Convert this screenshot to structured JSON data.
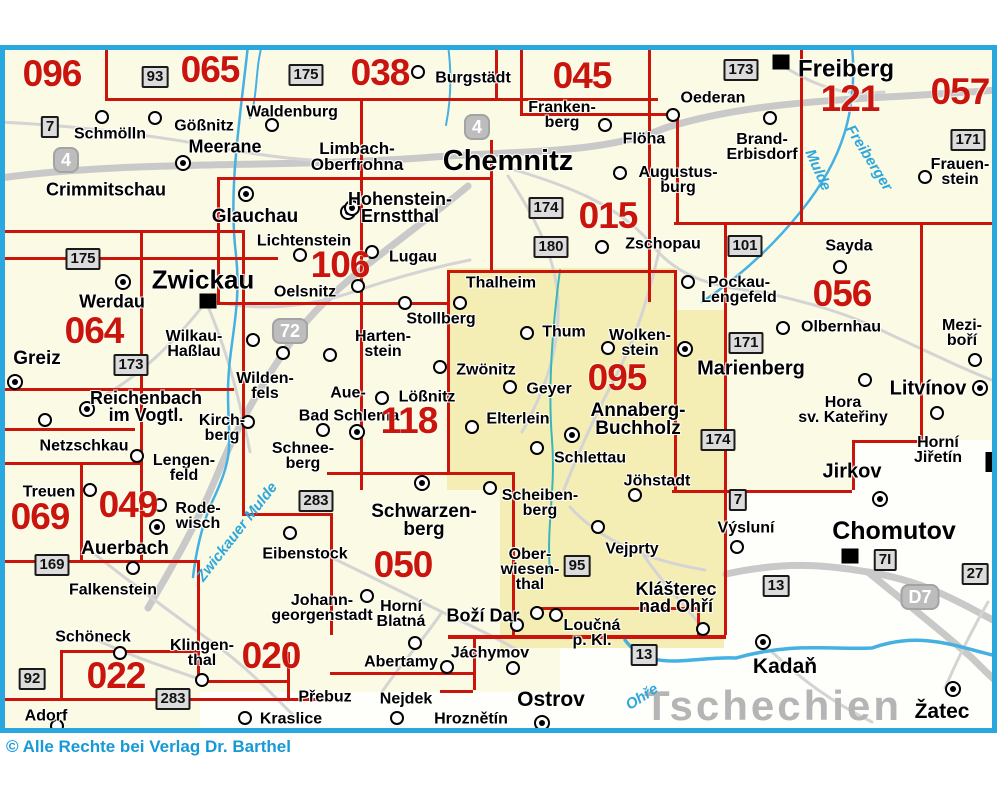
{
  "map": {
    "country_label": "Tschechien",
    "copyright": "© Alle Rechte bei Verlag Dr. Barthel",
    "colors": {
      "sheet_red": "#c9150c",
      "frame_blue": "#29a8e0",
      "river_blue": "#45b0e2",
      "base_cream": "#fbfae4",
      "highlight_yellow": "#f4eeb4",
      "road_gray": "#c9c9c9",
      "copyright_blue": "#1699d6",
      "country_gray": "#b5b5b5"
    },
    "sheet_numbers": [
      {
        "n": "096",
        "x": 52,
        "y": 74
      },
      {
        "n": "065",
        "x": 210,
        "y": 70
      },
      {
        "n": "038",
        "x": 380,
        "y": 73
      },
      {
        "n": "045",
        "x": 582,
        "y": 76
      },
      {
        "n": "121",
        "x": 850,
        "y": 99
      },
      {
        "n": "057",
        "x": 960,
        "y": 92
      },
      {
        "n": "015",
        "x": 608,
        "y": 216
      },
      {
        "n": "106",
        "x": 340,
        "y": 265
      },
      {
        "n": "056",
        "x": 842,
        "y": 294
      },
      {
        "n": "064",
        "x": 94,
        "y": 331
      },
      {
        "n": "095",
        "x": 617,
        "y": 378
      },
      {
        "n": "118",
        "x": 409,
        "y": 421
      },
      {
        "n": "069",
        "x": 40,
        "y": 517
      },
      {
        "n": "049",
        "x": 128,
        "y": 505
      },
      {
        "n": "050",
        "x": 403,
        "y": 565
      },
      {
        "n": "022",
        "x": 116,
        "y": 676
      },
      {
        "n": "020",
        "x": 271,
        "y": 656
      }
    ],
    "towns": [
      {
        "t": [
          "Schmölln"
        ],
        "x": 110,
        "y": 134
      },
      {
        "t": [
          "Gößnitz"
        ],
        "x": 204,
        "y": 126
      },
      {
        "t": [
          "Meerane"
        ],
        "x": 225,
        "y": 147,
        "s": 18
      },
      {
        "t": [
          "Waldenburg"
        ],
        "x": 292,
        "y": 112
      },
      {
        "t": [
          "Limbach-",
          "Oberfrohna"
        ],
        "x": 357,
        "y": 157,
        "s": 17
      },
      {
        "t": [
          "Burgstädt"
        ],
        "x": 473,
        "y": 78
      },
      {
        "t": [
          "Chemnitz"
        ],
        "x": 508,
        "y": 162,
        "s": 29
      },
      {
        "t": [
          "Franken-",
          "berg"
        ],
        "x": 562,
        "y": 115
      },
      {
        "t": [
          "Flöha"
        ],
        "x": 644,
        "y": 139
      },
      {
        "t": [
          "Oederan"
        ],
        "x": 713,
        "y": 98
      },
      {
        "t": [
          "Freiberg"
        ],
        "x": 846,
        "y": 70,
        "s": 24
      },
      {
        "t": [
          "Brand-",
          "Erbisdorf"
        ],
        "x": 762,
        "y": 147
      },
      {
        "t": [
          "Frauen-",
          "stein"
        ],
        "x": 960,
        "y": 172
      },
      {
        "t": [
          "Augustus-",
          "burg"
        ],
        "x": 678,
        "y": 180
      },
      {
        "t": [
          "Crimmitschau"
        ],
        "x": 106,
        "y": 190,
        "s": 18
      },
      {
        "t": [
          "Glauchau"
        ],
        "x": 255,
        "y": 217,
        "s": 19
      },
      {
        "t": [
          "Hohenstein-",
          "Ernstthal"
        ],
        "x": 400,
        "y": 208,
        "s": 18
      },
      {
        "t": [
          "Lichtenstein"
        ],
        "x": 304,
        "y": 241
      },
      {
        "t": [
          "Zschopau"
        ],
        "x": 663,
        "y": 244
      },
      {
        "t": [
          "Lugau"
        ],
        "x": 413,
        "y": 257
      },
      {
        "t": [
          "Oelsnitz"
        ],
        "x": 305,
        "y": 292
      },
      {
        "t": [
          "Sayda"
        ],
        "x": 849,
        "y": 246
      },
      {
        "t": [
          "Pockau-",
          "Lengefeld"
        ],
        "x": 739,
        "y": 290
      },
      {
        "t": [
          "Olbernhau"
        ],
        "x": 841,
        "y": 327
      },
      {
        "t": [
          "Zwickau"
        ],
        "x": 203,
        "y": 280,
        "s": 26
      },
      {
        "t": [
          "Werdau"
        ],
        "x": 112,
        "y": 302,
        "s": 18
      },
      {
        "t": [
          "Thalheim"
        ],
        "x": 501,
        "y": 283
      },
      {
        "t": [
          "Thum"
        ],
        "x": 564,
        "y": 332
      },
      {
        "t": [
          "Wolken-",
          "stein"
        ],
        "x": 640,
        "y": 343
      },
      {
        "t": [
          "Marienberg"
        ],
        "x": 751,
        "y": 369,
        "s": 20
      },
      {
        "t": [
          "Mezi-",
          "boří"
        ],
        "x": 962,
        "y": 333
      },
      {
        "t": [
          "Greiz"
        ],
        "x": 37,
        "y": 359,
        "s": 19
      },
      {
        "t": [
          "Wilkau-",
          "Haßlau"
        ],
        "x": 194,
        "y": 344
      },
      {
        "t": [
          "Harten-",
          "stein"
        ],
        "x": 383,
        "y": 344
      },
      {
        "t": [
          "Stollberg"
        ],
        "x": 441,
        "y": 319
      },
      {
        "t": [
          "Zwönitz"
        ],
        "x": 486,
        "y": 370
      },
      {
        "t": [
          "Geyer"
        ],
        "x": 549,
        "y": 389
      },
      {
        "t": [
          "Litvínov"
        ],
        "x": 928,
        "y": 389,
        "s": 20
      },
      {
        "t": [
          "Hora",
          "sv. Kateřiny"
        ],
        "x": 843,
        "y": 410
      },
      {
        "t": [
          "Reichenbach",
          "im Vogtl."
        ],
        "x": 146,
        "y": 407,
        "s": 18
      },
      {
        "t": [
          "Wilden-",
          "fels"
        ],
        "x": 265,
        "y": 386
      },
      {
        "t": [
          "Kirch-",
          "berg"
        ],
        "x": 222,
        "y": 428
      },
      {
        "t": [
          "Aue-"
        ],
        "x": 348,
        "y": 393
      },
      {
        "t": [
          "Bad Schlema"
        ],
        "x": 349,
        "y": 416
      },
      {
        "t": [
          "Lößnitz"
        ],
        "x": 427,
        "y": 397
      },
      {
        "t": [
          "Elterlein"
        ],
        "x": 518,
        "y": 419
      },
      {
        "t": [
          "Annaberg-",
          "Buchholz"
        ],
        "x": 638,
        "y": 420,
        "s": 19
      },
      {
        "t": [
          "Horní",
          "Jiřetín"
        ],
        "x": 938,
        "y": 450
      },
      {
        "t": [
          "Netzschkau"
        ],
        "x": 84,
        "y": 446
      },
      {
        "t": [
          "Schlettau"
        ],
        "x": 590,
        "y": 458
      },
      {
        "t": [
          "Jöhstadt"
        ],
        "x": 657,
        "y": 481
      },
      {
        "t": [
          "Jirkov"
        ],
        "x": 852,
        "y": 472,
        "s": 20
      },
      {
        "t": [
          "Lengen-",
          "feld"
        ],
        "x": 184,
        "y": 468
      },
      {
        "t": [
          "Treuen"
        ],
        "x": 49,
        "y": 492
      },
      {
        "t": [
          "Rode-",
          "wisch"
        ],
        "x": 198,
        "y": 516
      },
      {
        "t": [
          "Schnee-",
          "berg"
        ],
        "x": 303,
        "y": 456
      },
      {
        "t": [
          "Výsluní"
        ],
        "x": 746,
        "y": 528
      },
      {
        "t": [
          "Chomutov"
        ],
        "x": 894,
        "y": 532,
        "s": 25
      },
      {
        "t": [
          "Auerbach"
        ],
        "x": 125,
        "y": 549,
        "s": 19
      },
      {
        "t": [
          "Eibenstock"
        ],
        "x": 305,
        "y": 554
      },
      {
        "t": [
          "Vejprty"
        ],
        "x": 632,
        "y": 549
      },
      {
        "t": [
          "Klášterec",
          "nad Ohří"
        ],
        "x": 676,
        "y": 598,
        "s": 18
      },
      {
        "t": [
          "Falkenstein"
        ],
        "x": 113,
        "y": 590
      },
      {
        "t": [
          "Scheiben-",
          "berg"
        ],
        "x": 540,
        "y": 503
      },
      {
        "t": [
          "Schwarzen-",
          "berg"
        ],
        "x": 424,
        "y": 521,
        "s": 19
      },
      {
        "t": [
          "Ober-",
          "wiesen-",
          "thal"
        ],
        "x": 530,
        "y": 570
      },
      {
        "t": [
          "Johann-",
          "georgenstadt"
        ],
        "x": 322,
        "y": 608
      },
      {
        "t": [
          "Horní",
          "Blatná"
        ],
        "x": 401,
        "y": 614
      },
      {
        "t": [
          "Boží Dar"
        ],
        "x": 483,
        "y": 616,
        "s": 18
      },
      {
        "t": [
          "Loučná",
          "p. Kl."
        ],
        "x": 592,
        "y": 633
      },
      {
        "t": [
          "Jáchymov"
        ],
        "x": 490,
        "y": 653
      },
      {
        "t": [
          "Abertamy"
        ],
        "x": 401,
        "y": 662
      },
      {
        "t": [
          "Ostrov"
        ],
        "x": 551,
        "y": 700,
        "s": 21
      },
      {
        "t": [
          "Hroznětín"
        ],
        "x": 471,
        "y": 719
      },
      {
        "t": [
          "Nejdek"
        ],
        "x": 406,
        "y": 699
      },
      {
        "t": [
          "Přebuz"
        ],
        "x": 325,
        "y": 697
      },
      {
        "t": [
          "Kraslice"
        ],
        "x": 291,
        "y": 719
      },
      {
        "t": [
          "Schöneck"
        ],
        "x": 93,
        "y": 637
      },
      {
        "t": [
          "Klingen-",
          "thal"
        ],
        "x": 202,
        "y": 653
      },
      {
        "t": [
          "Adorf"
        ],
        "x": 46,
        "y": 716
      },
      {
        "t": [
          "Kadaň"
        ],
        "x": 785,
        "y": 667,
        "s": 21
      },
      {
        "t": [
          "Žatec"
        ],
        "x": 942,
        "y": 712,
        "s": 21
      }
    ],
    "road_badges": [
      {
        "n": "7",
        "x": 50,
        "y": 127,
        "k": "b"
      },
      {
        "n": "93",
        "x": 155,
        "y": 77,
        "k": "b"
      },
      {
        "n": "175",
        "x": 306,
        "y": 75,
        "k": "b"
      },
      {
        "n": "173",
        "x": 741,
        "y": 70,
        "k": "b"
      },
      {
        "n": "171",
        "x": 968,
        "y": 140,
        "k": "b"
      },
      {
        "n": "4",
        "x": 66,
        "y": 160,
        "k": "a"
      },
      {
        "n": "4",
        "x": 477,
        "y": 127,
        "k": "a"
      },
      {
        "n": "174",
        "x": 546,
        "y": 208,
        "k": "b"
      },
      {
        "n": "180",
        "x": 551,
        "y": 247,
        "k": "b"
      },
      {
        "n": "101",
        "x": 745,
        "y": 246,
        "k": "b"
      },
      {
        "n": "175",
        "x": 83,
        "y": 259,
        "k": "b"
      },
      {
        "n": "72",
        "x": 290,
        "y": 331,
        "k": "a"
      },
      {
        "n": "173",
        "x": 131,
        "y": 365,
        "k": "b"
      },
      {
        "n": "171",
        "x": 746,
        "y": 343,
        "k": "b"
      },
      {
        "n": "174",
        "x": 718,
        "y": 440,
        "k": "b"
      },
      {
        "n": "7",
        "x": 738,
        "y": 500,
        "k": "b"
      },
      {
        "n": "169",
        "x": 52,
        "y": 565,
        "k": "b"
      },
      {
        "n": "283",
        "x": 316,
        "y": 501,
        "k": "b"
      },
      {
        "n": "95",
        "x": 577,
        "y": 566,
        "k": "b"
      },
      {
        "n": "13",
        "x": 776,
        "y": 586,
        "k": "b"
      },
      {
        "n": "7I",
        "x": 885,
        "y": 560,
        "k": "b"
      },
      {
        "n": "27",
        "x": 975,
        "y": 574,
        "k": "b"
      },
      {
        "n": "D7",
        "x": 920,
        "y": 597,
        "k": "a"
      },
      {
        "n": "13",
        "x": 644,
        "y": 655,
        "k": "b"
      },
      {
        "n": "92",
        "x": 32,
        "y": 679,
        "k": "b"
      },
      {
        "n": "283",
        "x": 173,
        "y": 699,
        "k": "b"
      }
    ],
    "river_labels": [
      {
        "t": "Zwickauer Mulde",
        "x": 237,
        "y": 532,
        "r": -52
      },
      {
        "t": "Freiberger",
        "x": 869,
        "y": 158,
        "r": 58
      },
      {
        "t": "Mulde",
        "x": 818,
        "y": 170,
        "r": 66
      },
      {
        "t": "Ohře",
        "x": 642,
        "y": 697,
        "r": -33
      }
    ],
    "markers": [
      {
        "x": 102,
        "y": 117,
        "k": "c"
      },
      {
        "x": 155,
        "y": 118,
        "k": "c"
      },
      {
        "x": 272,
        "y": 125,
        "k": "c"
      },
      {
        "x": 183,
        "y": 163,
        "k": "d"
      },
      {
        "x": 418,
        "y": 72,
        "k": "c"
      },
      {
        "x": 605,
        "y": 125,
        "k": "c"
      },
      {
        "x": 673,
        "y": 115,
        "k": "c"
      },
      {
        "x": 770,
        "y": 118,
        "k": "c"
      },
      {
        "x": 925,
        "y": 177,
        "k": "c"
      },
      {
        "x": 620,
        "y": 173,
        "k": "c"
      },
      {
        "x": 348,
        "y": 212,
        "k": "d"
      },
      {
        "x": 246,
        "y": 194,
        "k": "d"
      },
      {
        "x": 352,
        "y": 208,
        "k": "d"
      },
      {
        "x": 300,
        "y": 255,
        "k": "c"
      },
      {
        "x": 372,
        "y": 252,
        "k": "c"
      },
      {
        "x": 358,
        "y": 286,
        "k": "c"
      },
      {
        "x": 602,
        "y": 247,
        "k": "c"
      },
      {
        "x": 123,
        "y": 282,
        "k": "d"
      },
      {
        "x": 208,
        "y": 301,
        "k": "sq"
      },
      {
        "x": 781,
        "y": 62,
        "k": "sq"
      },
      {
        "x": 253,
        "y": 340,
        "k": "c"
      },
      {
        "x": 283,
        "y": 353,
        "k": "c"
      },
      {
        "x": 330,
        "y": 355,
        "k": "c"
      },
      {
        "x": 405,
        "y": 303,
        "k": "c"
      },
      {
        "x": 460,
        "y": 303,
        "k": "c"
      },
      {
        "x": 440,
        "y": 367,
        "k": "c"
      },
      {
        "x": 510,
        "y": 387,
        "k": "c"
      },
      {
        "x": 527,
        "y": 333,
        "k": "c"
      },
      {
        "x": 608,
        "y": 348,
        "k": "c"
      },
      {
        "x": 472,
        "y": 427,
        "k": "c"
      },
      {
        "x": 537,
        "y": 448,
        "k": "c"
      },
      {
        "x": 572,
        "y": 435,
        "k": "d"
      },
      {
        "x": 635,
        "y": 495,
        "k": "c"
      },
      {
        "x": 685,
        "y": 349,
        "k": "d"
      },
      {
        "x": 688,
        "y": 282,
        "k": "c"
      },
      {
        "x": 840,
        "y": 267,
        "k": "c"
      },
      {
        "x": 783,
        "y": 328,
        "k": "c"
      },
      {
        "x": 975,
        "y": 360,
        "k": "c"
      },
      {
        "x": 980,
        "y": 388,
        "k": "d"
      },
      {
        "x": 865,
        "y": 380,
        "k": "c"
      },
      {
        "x": 937,
        "y": 413,
        "k": "c"
      },
      {
        "x": 737,
        "y": 547,
        "k": "c"
      },
      {
        "x": 880,
        "y": 499,
        "k": "d"
      },
      {
        "x": 850,
        "y": 556,
        "k": "sq"
      },
      {
        "x": 598,
        "y": 527,
        "k": "c"
      },
      {
        "x": 490,
        "y": 488,
        "k": "c"
      },
      {
        "x": 422,
        "y": 483,
        "k": "d"
      },
      {
        "x": 537,
        "y": 613,
        "k": "c"
      },
      {
        "x": 556,
        "y": 615,
        "k": "c"
      },
      {
        "x": 517,
        "y": 625,
        "k": "c"
      },
      {
        "x": 513,
        "y": 668,
        "k": "c"
      },
      {
        "x": 447,
        "y": 667,
        "k": "c"
      },
      {
        "x": 415,
        "y": 643,
        "k": "c"
      },
      {
        "x": 703,
        "y": 629,
        "k": "c"
      },
      {
        "x": 763,
        "y": 642,
        "k": "d"
      },
      {
        "x": 953,
        "y": 689,
        "k": "d"
      },
      {
        "x": 542,
        "y": 723,
        "k": "d"
      },
      {
        "x": 397,
        "y": 718,
        "k": "c"
      },
      {
        "x": 245,
        "y": 718,
        "k": "c"
      },
      {
        "x": 202,
        "y": 680,
        "k": "c"
      },
      {
        "x": 120,
        "y": 653,
        "k": "c"
      },
      {
        "x": 57,
        "y": 726,
        "k": "c"
      },
      {
        "x": 133,
        "y": 568,
        "k": "c"
      },
      {
        "x": 160,
        "y": 505,
        "k": "c"
      },
      {
        "x": 157,
        "y": 527,
        "k": "d"
      },
      {
        "x": 90,
        "y": 490,
        "k": "c"
      },
      {
        "x": 137,
        "y": 456,
        "k": "c"
      },
      {
        "x": 45,
        "y": 420,
        "k": "c"
      },
      {
        "x": 15,
        "y": 382,
        "k": "d"
      },
      {
        "x": 87,
        "y": 409,
        "k": "d"
      },
      {
        "x": 248,
        "y": 422,
        "k": "c"
      },
      {
        "x": 357,
        "y": 432,
        "k": "d"
      },
      {
        "x": 323,
        "y": 430,
        "k": "c"
      },
      {
        "x": 382,
        "y": 398,
        "k": "c"
      },
      {
        "x": 367,
        "y": 596,
        "k": "c"
      },
      {
        "x": 290,
        "y": 533,
        "k": "c"
      },
      {
        "x": 990,
        "y": 462,
        "k": "bar"
      }
    ]
  }
}
